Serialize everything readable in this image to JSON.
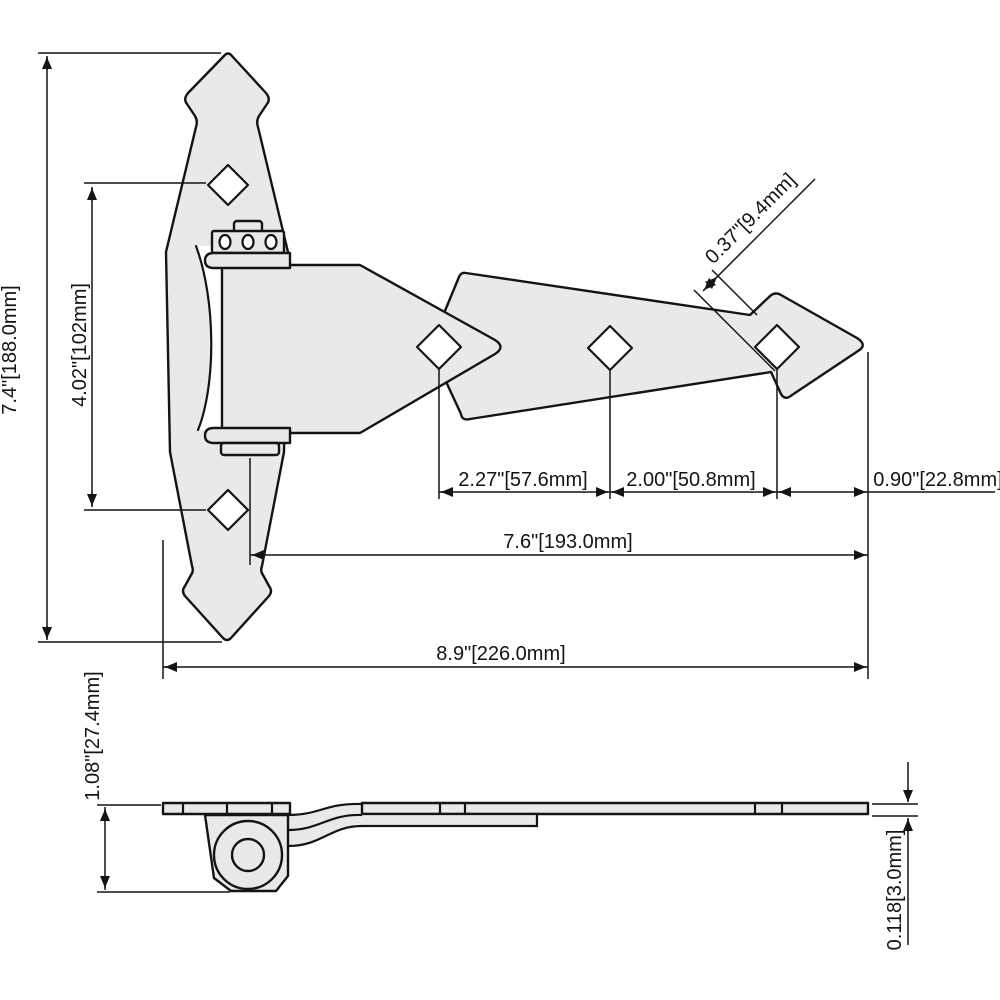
{
  "colors": {
    "metal_fill": "#e9e9e9",
    "line_color": "#141414",
    "background": "#ffffff"
  },
  "dimensions": {
    "overall_height": "7.4\"[188.0mm]",
    "vertical_hole_spacing": "4.02\"[102mm]",
    "neck_width": "0.37\"[9.4mm]",
    "center_hole_spacing": "2.27\"[57.6mm]",
    "end_hole_spacing": "2.00\"[50.8mm]",
    "hole_to_tip": "0.90\"[22.8mm]",
    "pin_to_tip": "7.6\"[193.0mm]",
    "overall_length": "8.9\"[226.0mm]",
    "side_profile_height": "1.08\"[27.4mm]",
    "leaf_thickness": "0.118[3.0mm]"
  }
}
